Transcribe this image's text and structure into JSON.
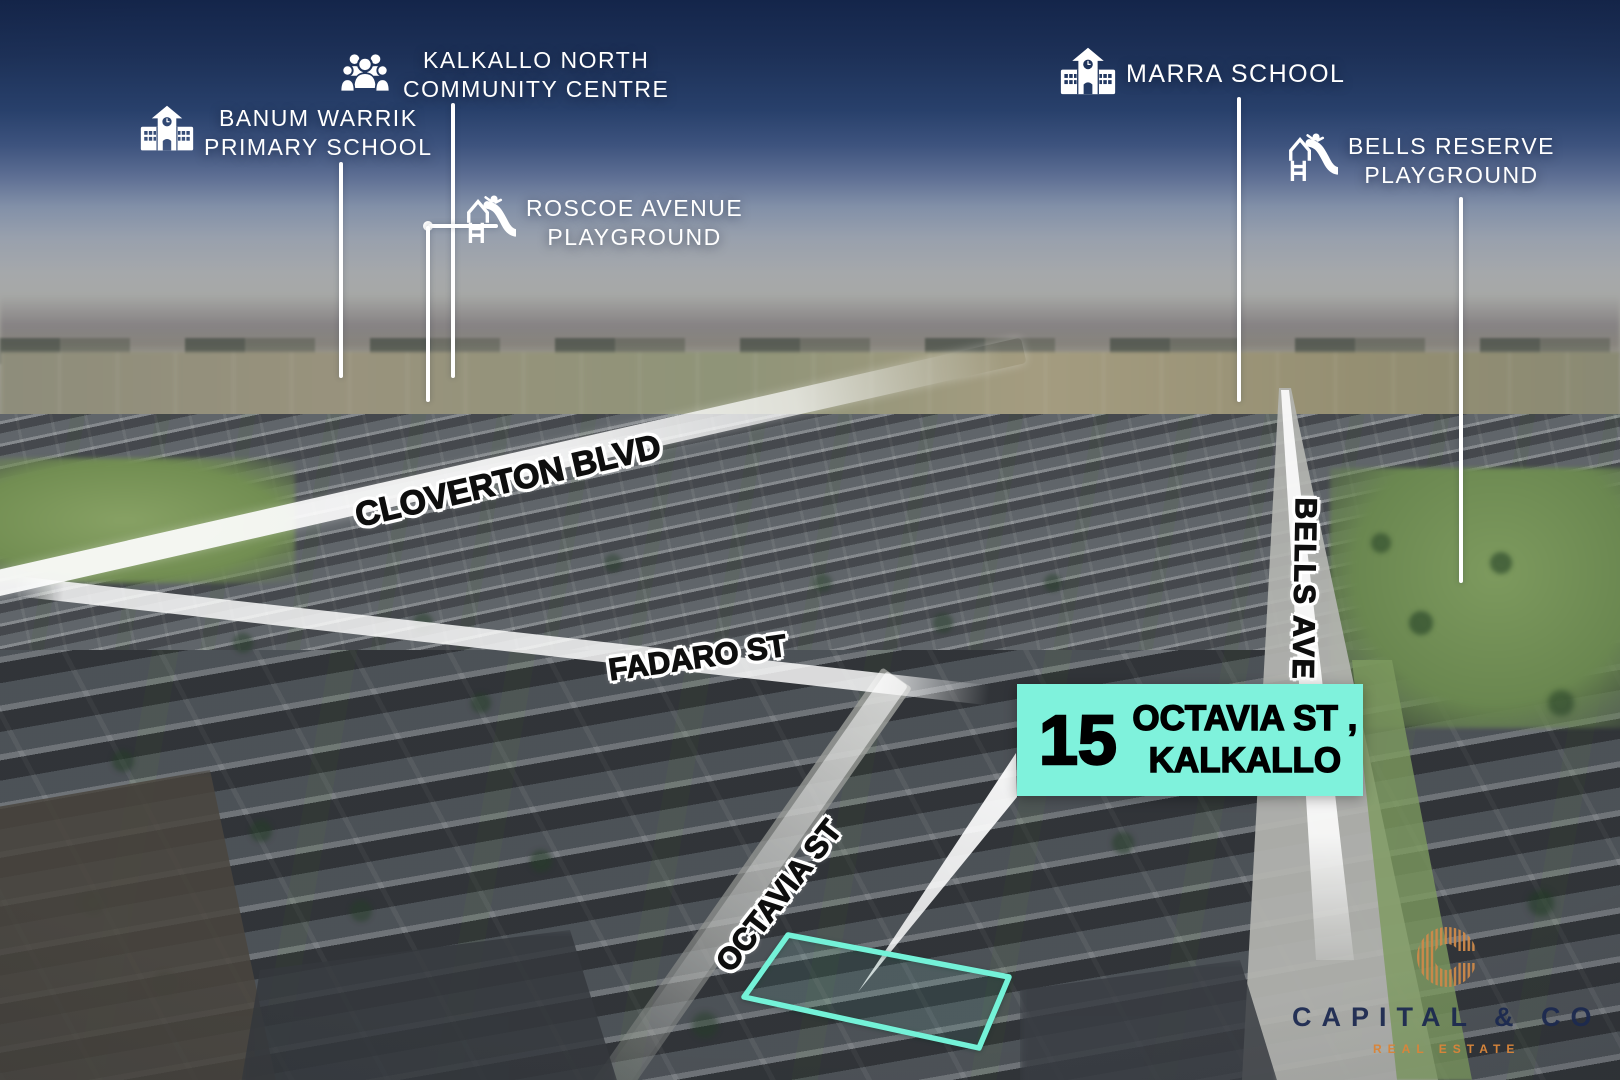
{
  "pois": [
    {
      "id": "banum-warrik-primary-school",
      "icon": "school-icon",
      "line1": "BANUM WARRIK",
      "line2": "PRIMARY SCHOOL"
    },
    {
      "id": "kalkallo-north-community-centre",
      "icon": "community-icon",
      "line1": "KALKALLO NORTH",
      "line2": "COMMUNITY CENTRE"
    },
    {
      "id": "roscoe-avenue-playground",
      "icon": "playground-icon",
      "line1": "ROSCOE AVENUE",
      "line2": "PLAYGROUND"
    },
    {
      "id": "marra-school",
      "icon": "school-icon",
      "line1": "MARRA SCHOOL",
      "line2": ""
    },
    {
      "id": "bells-reserve-playground",
      "icon": "playground-icon",
      "line1": "BELLS RESERVE",
      "line2": "PLAYGROUND"
    }
  ],
  "streets": {
    "cloverton": "CLOVERTON BLVD",
    "fadaro": "FADARO ST",
    "bells": "BELLS AVE",
    "octavia": "OCTAVIA ST"
  },
  "callout": {
    "number": "15",
    "line1": "OCTAVIA ST ,",
    "line2": "KALKALLO",
    "bg_color": "#7ff2dc"
  },
  "property_outline_color": "#74f2d8",
  "brand": {
    "wordmark": "CAPITAL & CO",
    "tagline": "REAL ESTATE",
    "wordmark_color": "#1d2b52",
    "tagline_color": "#e08a3c",
    "monogram_color": "#cf8a4a"
  }
}
